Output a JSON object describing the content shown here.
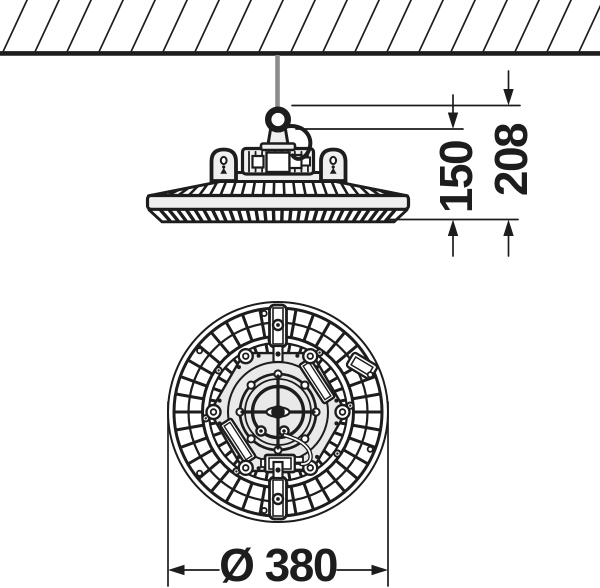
{
  "dimensions": {
    "height_fixture": "150",
    "height_total": "208",
    "diameter": "Ø 380"
  },
  "colors": {
    "line": "#1d1d1d",
    "cable": "#8c8c8c",
    "plate": "#e9e9e9",
    "part_fill": "#efefef",
    "background": "#ffffff"
  }
}
